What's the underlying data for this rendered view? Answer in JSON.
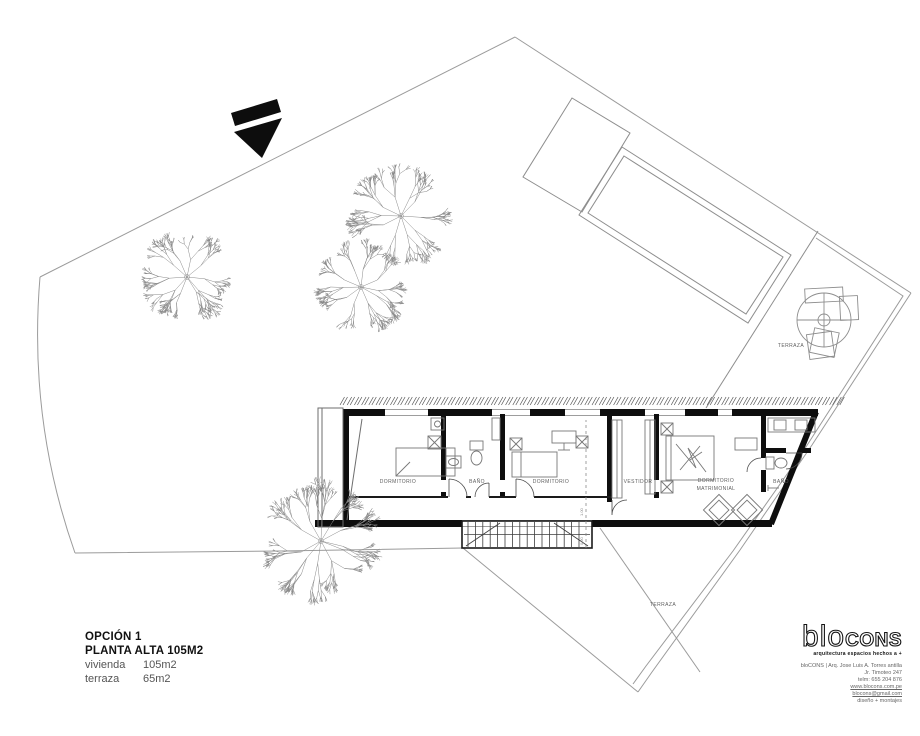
{
  "site": {
    "trees": [
      {
        "x": 187,
        "y": 277,
        "r": 52
      },
      {
        "x": 401,
        "y": 216,
        "r": 58
      },
      {
        "x": 361,
        "y": 287,
        "r": 52
      },
      {
        "x": 321,
        "y": 541,
        "r": 66
      }
    ]
  },
  "plan": {
    "rooms": [
      {
        "label": "DORMITORIO"
      },
      {
        "label": "BAÑO"
      },
      {
        "label": "DORMITORIO"
      },
      {
        "label": "VESTIDOR"
      },
      {
        "label": "DORMITORIO"
      },
      {
        "label": "MATRIMONIAL"
      },
      {
        "label": "BAÑO"
      }
    ],
    "terrace_upper_label": "TERRAZA",
    "terrace_lower_label": "TERRAZA",
    "stairs_dims": [
      "1.00",
      "0.90"
    ]
  },
  "title_block": {
    "option": "OPCIÓN 1",
    "plan_name": "PLANTA ALTA 105M2",
    "areas": [
      {
        "label": "vivienda",
        "value": "105m2"
      },
      {
        "label": "terraza",
        "value": "65m2"
      }
    ]
  },
  "logo": {
    "blo": "blo",
    "cons": "CONS",
    "tagline": "arquitectura espacios hechos a +",
    "contact": [
      {
        "text": "bloCONS | Arq. Jose Luis A. Torres antilla",
        "underline": false
      },
      {
        "text": "Jr. Timoteo 247",
        "underline": false
      },
      {
        "text": "telm: 655 204 876",
        "underline": false
      },
      {
        "text": "www.blocons.com.pe",
        "underline": true
      },
      {
        "text": "blocons@gmail.com",
        "underline": true
      },
      {
        "text": "diseño + montajes",
        "underline": false
      }
    ]
  }
}
